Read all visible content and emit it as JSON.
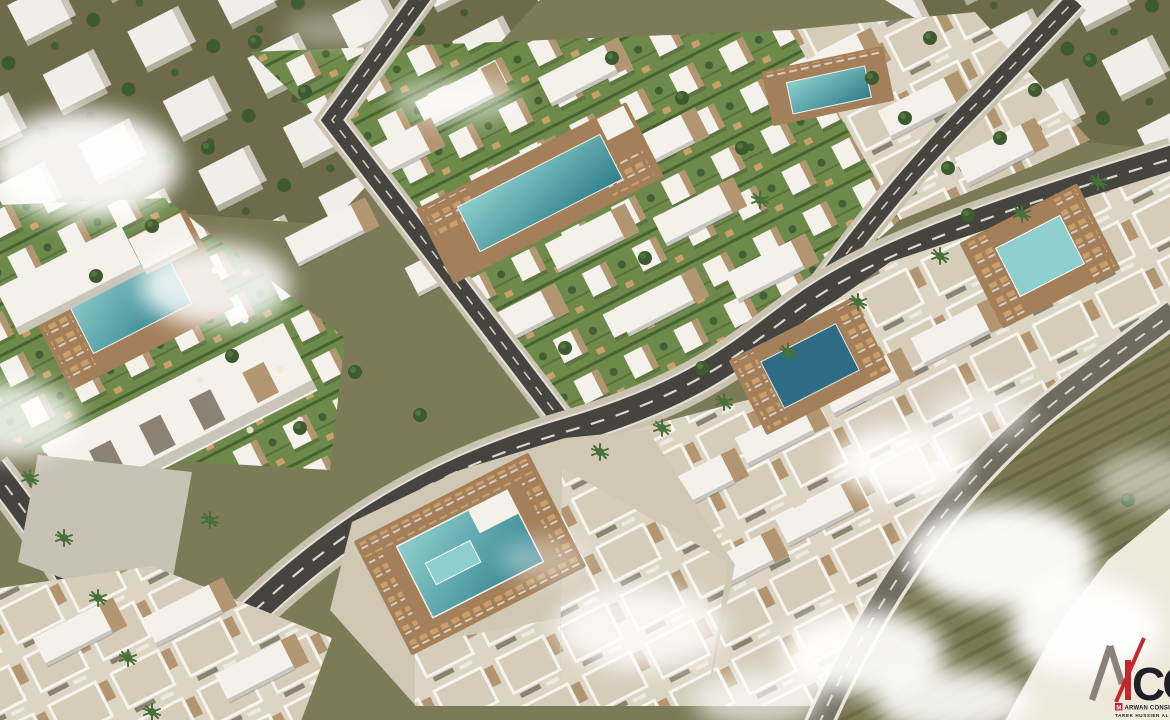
{
  "watermark": {
    "monogram_cc": "CC",
    "chip_letter": "M",
    "company_line": "ARWAN CONSU",
    "name_line": "TAREK HUSSIEN AL"
  },
  "palette": {
    "ground": "#7d7a58",
    "zone": "#6e6b4b",
    "block-white": "#efeee8",
    "block-shadow": "#c9c5b8",
    "tree": "#3e5a31",
    "tree-light": "#5c7f41",
    "palm": "#47703a",
    "lawn": "#6d8a4b",
    "hedge": "#49632f",
    "unit-white": "#f3f1ea",
    "stone": "#b29671",
    "roof-base": "#ddd5c4",
    "roof-inner": "#d5ccba",
    "parapet": "#f6f4ed",
    "slot": "#8a8273",
    "curb": "#c9c2b0",
    "asphalt": "#45443e",
    "asphalt-light": "#6f6b5e",
    "road-white": "#e4e1d6",
    "plaza": "#d0c8b5",
    "plaza-gray": "#c7c2b4",
    "deck": "#a3805a",
    "lounger": "#c9a06c",
    "pool-deep": "#2f7f8c",
    "pool-mid": "#4ea2a8",
    "pool-light": "#8ecfcd",
    "pool-dark": "#2e6b85",
    "field": "#7a7750",
    "field-row": "#6a6745",
    "sand": "#efe9dc",
    "smoke": "#ffffff",
    "logo-gray": "#8d8177",
    "logo-red": "#c5272d",
    "logo-dark": "#202024"
  }
}
